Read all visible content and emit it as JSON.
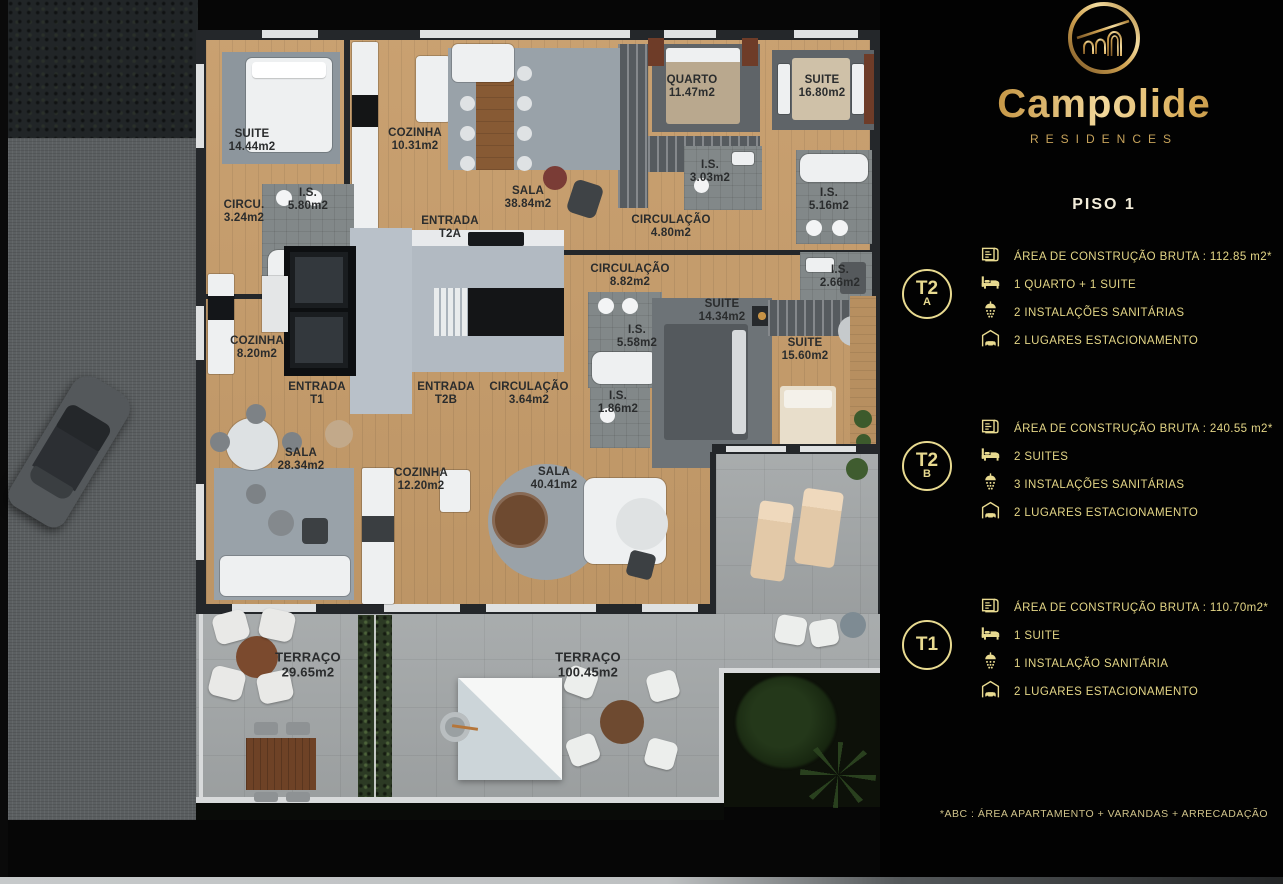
{
  "brand": {
    "name": "Campolide",
    "tagline": "RESIDENCES"
  },
  "floor_title": "PISO 1",
  "units": [
    {
      "id": "T2A",
      "badge": {
        "line1": "T2",
        "line2": "A"
      },
      "specs": [
        {
          "icon": "floorplan-icon",
          "text": "ÁREA DE CONSTRUÇÃO BRUTA :  112.85 m2*"
        },
        {
          "icon": "bed-icon",
          "text": "1 QUARTO + 1 SUITE"
        },
        {
          "icon": "shower-icon",
          "text": "2 INSTALAÇÕES SANITÁRIAS"
        },
        {
          "icon": "car-icon",
          "text": "2 LUGARES ESTACIONAMENTO"
        }
      ]
    },
    {
      "id": "T2B",
      "badge": {
        "line1": "T2",
        "line2": "B"
      },
      "specs": [
        {
          "icon": "floorplan-icon",
          "text": "ÁREA DE CONSTRUÇÃO BRUTA :  240.55 m2*"
        },
        {
          "icon": "bed-icon",
          "text": "2 SUITES"
        },
        {
          "icon": "shower-icon",
          "text": "3 INSTALAÇÕES SANITÁRIAS"
        },
        {
          "icon": "car-icon",
          "text": "2 LUGARES ESTACIONAMENTO"
        }
      ]
    },
    {
      "id": "T1",
      "badge": {
        "line1": "T1",
        "line2": ""
      },
      "specs": [
        {
          "icon": "floorplan-icon",
          "text": "ÁREA DE CONSTRUÇÃO BRUTA :  110.70m2*"
        },
        {
          "icon": "bed-icon",
          "text": "1 SUITE"
        },
        {
          "icon": "shower-icon",
          "text": "1 INSTALAÇÃO SANITÁRIA"
        },
        {
          "icon": "car-icon",
          "text": "2 LUGARES ESTACIONAMENTO"
        }
      ]
    }
  ],
  "footnote": "*ABC :  ÁREA APARTAMENTO + VARANDAS + ARRECADAÇÃO",
  "floorplan": {
    "labels": [
      {
        "name": "SUITE",
        "area": "14.44m2",
        "x": 252,
        "y": 141
      },
      {
        "name": "COZINHA",
        "area": "10.31m2",
        "x": 415,
        "y": 140
      },
      {
        "name": "SALA",
        "area": "38.84m2",
        "x": 528,
        "y": 198
      },
      {
        "name": "QUARTO",
        "area": "11.47m2",
        "x": 692,
        "y": 87
      },
      {
        "name": "SUITE",
        "area": "16.80m2",
        "x": 822,
        "y": 87
      },
      {
        "name": "I.S.",
        "area": "3.03m2",
        "x": 710,
        "y": 172
      },
      {
        "name": "I.S.",
        "area": "5.16m2",
        "x": 829,
        "y": 200
      },
      {
        "name": "CIRCULAÇÃO",
        "area": "4.80m2",
        "x": 671,
        "y": 227
      },
      {
        "name": "I.S.",
        "area": "5.80m2",
        "x": 308,
        "y": 200
      },
      {
        "name": "CIRCU.",
        "area": "3.24m2",
        "x": 244,
        "y": 212
      },
      {
        "name": "ENTRADA",
        "area": "T2A",
        "x": 450,
        "y": 228
      },
      {
        "name": "CIRCULAÇÃO",
        "area": "8.82m2",
        "x": 630,
        "y": 276
      },
      {
        "name": "I.S.",
        "area": "2.66m2",
        "x": 840,
        "y": 277
      },
      {
        "name": "SUITE",
        "area": "14.34m2",
        "x": 722,
        "y": 311
      },
      {
        "name": "I.S.",
        "area": "5.58m2",
        "x": 637,
        "y": 337
      },
      {
        "name": "SUITE",
        "area": "15.60m2",
        "x": 805,
        "y": 350
      },
      {
        "name": "COZINHA",
        "area": "8.20m2",
        "x": 257,
        "y": 348
      },
      {
        "name": "ENTRADA",
        "area": "T1",
        "x": 317,
        "y": 394
      },
      {
        "name": "ENTRADA",
        "area": "T2B",
        "x": 446,
        "y": 394
      },
      {
        "name": "CIRCULAÇÃO",
        "area": "3.64m2",
        "x": 529,
        "y": 394
      },
      {
        "name": "I.S.",
        "area": "1.86m2",
        "x": 618,
        "y": 403
      },
      {
        "name": "SALA",
        "area": "28.34m2",
        "x": 301,
        "y": 460
      },
      {
        "name": "COZINHA",
        "area": "12.20m2",
        "x": 421,
        "y": 480
      },
      {
        "name": "SALA",
        "area": "40.41m2",
        "x": 554,
        "y": 479
      },
      {
        "name": "TERRAÇO",
        "area": "29.65m2",
        "x": 308,
        "y": 665,
        "big": true
      },
      {
        "name": "TERRAÇO",
        "area": "100.45m2",
        "x": 588,
        "y": 665,
        "big": true
      }
    ]
  },
  "colors": {
    "accent_gold": "#e8da90",
    "brand_gold": "#d2a452",
    "panel_bg": "#000000",
    "wood_floor": "#c79d6b",
    "terrace_concrete": "#a4a8a9",
    "label_ink": "#2a2c2d"
  }
}
